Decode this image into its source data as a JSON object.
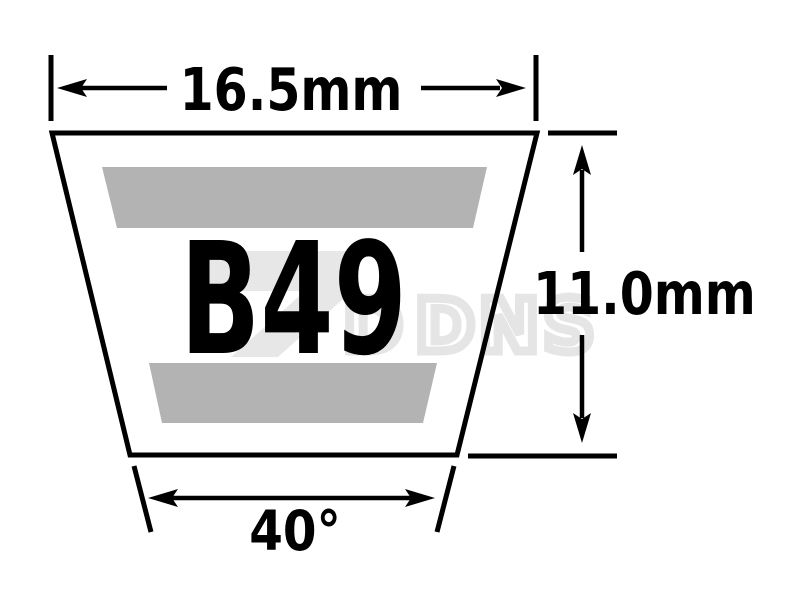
{
  "diagram": {
    "type": "v-belt-cross-section",
    "part_label": "B49",
    "dimensions": {
      "top_width": "16.5mm",
      "height": "11.0mm",
      "angle": "40°"
    },
    "watermark": {
      "visible_text": "DNS",
      "hidden_letter": "D"
    },
    "colors": {
      "background": "#ffffff",
      "outline": "#000000",
      "label_text": "#000000",
      "fabric_band_gray": "#b3b3b3",
      "watermark_gray": "#e7e7e7"
    }
  }
}
